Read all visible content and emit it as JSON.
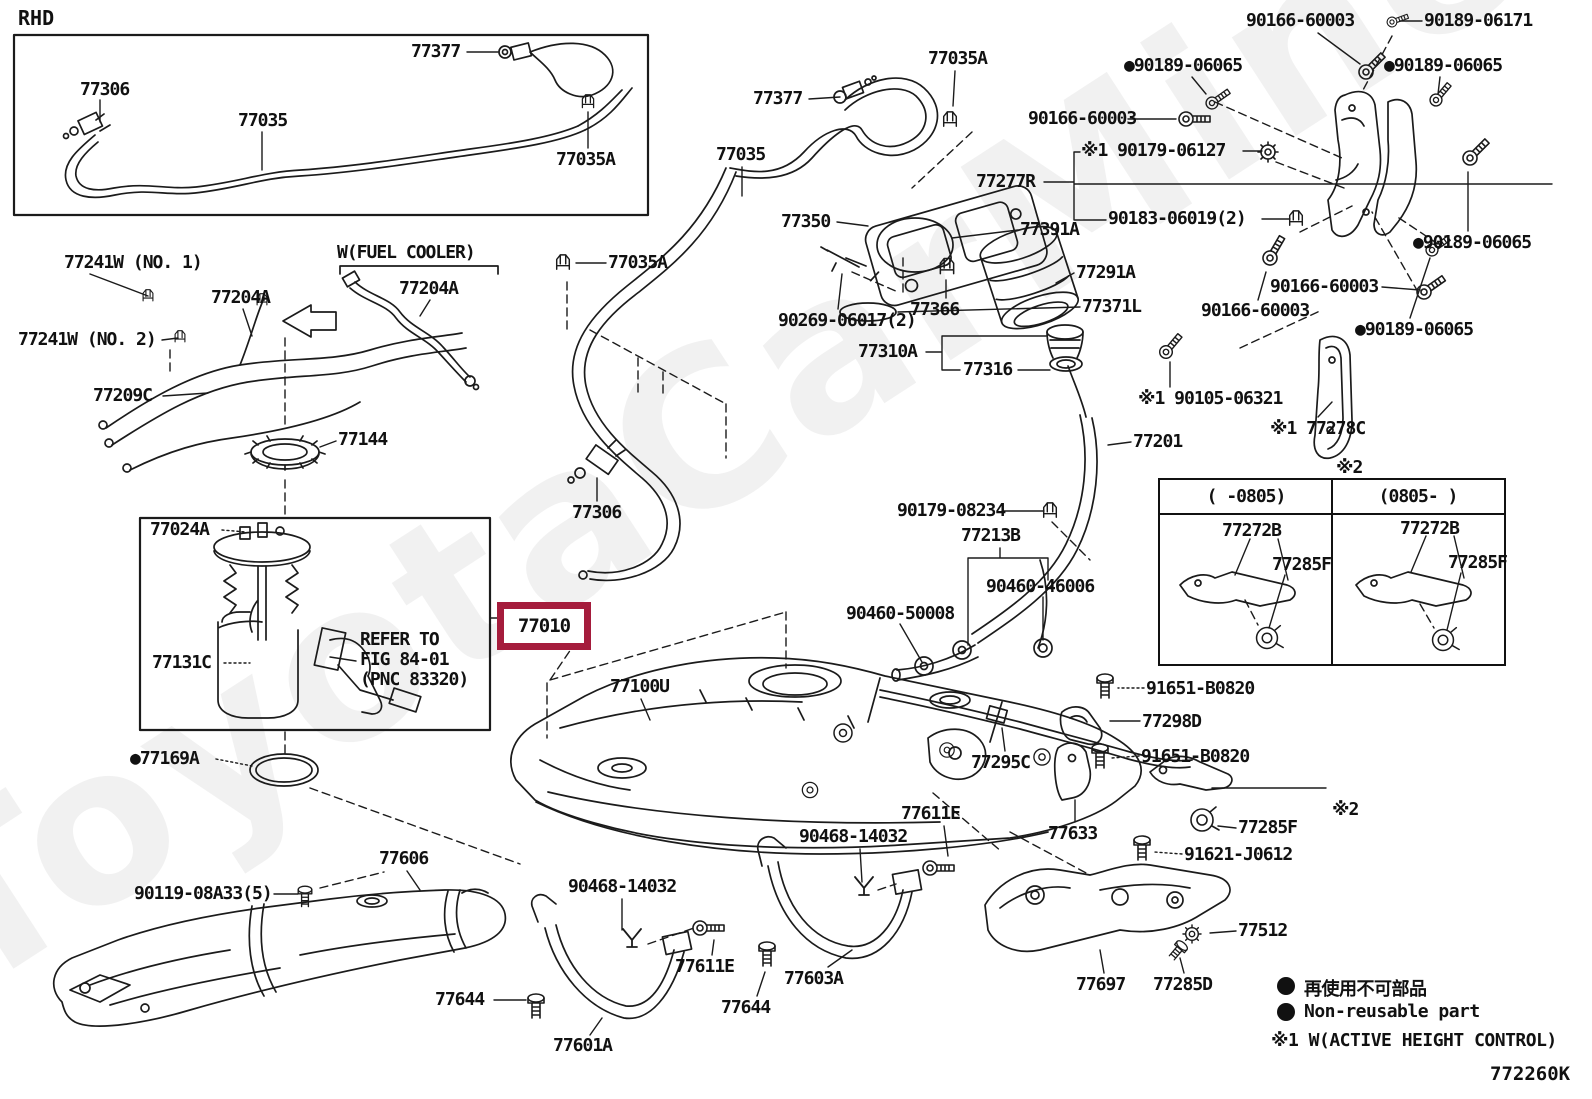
{
  "watermark": "ToyotaCarMine.ru",
  "diagram_code": "772260K",
  "inset_title": "RHD",
  "highlight": {
    "part_number": "77010",
    "box_color": "#A51C3C"
  },
  "legend": {
    "non_reusable_jp": "再使用不可部品",
    "non_reusable_en": "Non-reusable part",
    "active_height_note": "※1 W(ACTIVE HEIGHT CONTROL)"
  },
  "variant_table": {
    "note": "※2",
    "columns": [
      {
        "period": "(  -0805)",
        "bracket": "77272B",
        "clamp": "77285F"
      },
      {
        "period": "(0805-  )",
        "bracket": "77272B",
        "clamp": "77285F"
      }
    ]
  },
  "labels": [
    {
      "text": "77306",
      "x": 80,
      "y": 80
    },
    {
      "text": "77035",
      "x": 238,
      "y": 111
    },
    {
      "text": "77377",
      "x": 411,
      "y": 42
    },
    {
      "text": "77035A",
      "x": 556,
      "y": 150
    },
    {
      "text": "77241W (NO. 1)",
      "x": 64,
      "y": 253
    },
    {
      "text": "77241W (NO. 2)",
      "x": 18,
      "y": 330
    },
    {
      "text": "77204A",
      "x": 211,
      "y": 288
    },
    {
      "text": "W(FUEL COOLER)",
      "x": 337,
      "y": 243
    },
    {
      "text": "77204A",
      "x": 399,
      "y": 279
    },
    {
      "text": "77209C",
      "x": 93,
      "y": 386
    },
    {
      "text": "77144",
      "x": 338,
      "y": 430
    },
    {
      "text": "77024A",
      "x": 150,
      "y": 520
    },
    {
      "text": "77131C",
      "x": 152,
      "y": 653
    },
    {
      "text": "REFER TO\nFIG 84-01\n(PNC 83320)",
      "x": 360,
      "y": 630
    },
    {
      "text": "●77169A",
      "x": 130,
      "y": 749
    },
    {
      "text": "77100U",
      "x": 610,
      "y": 677
    },
    {
      "text": "77035A",
      "x": 608,
      "y": 253
    },
    {
      "text": "77306",
      "x": 572,
      "y": 503
    },
    {
      "text": "77035",
      "x": 716,
      "y": 145
    },
    {
      "text": "77377",
      "x": 753,
      "y": 89
    },
    {
      "text": "77035A",
      "x": 928,
      "y": 49
    },
    {
      "text": "77350",
      "x": 781,
      "y": 212
    },
    {
      "text": "90269-06017(2)",
      "x": 778,
      "y": 311
    },
    {
      "text": "77366",
      "x": 910,
      "y": 300
    },
    {
      "text": "77391A",
      "x": 1020,
      "y": 220
    },
    {
      "text": "77291A",
      "x": 1076,
      "y": 263
    },
    {
      "text": "77371L",
      "x": 1082,
      "y": 297
    },
    {
      "text": "77310A",
      "x": 858,
      "y": 342
    },
    {
      "text": "77316",
      "x": 963,
      "y": 360
    },
    {
      "text": "77277R",
      "x": 976,
      "y": 172
    },
    {
      "text": "90166-60003",
      "x": 1028,
      "y": 109
    },
    {
      "text": "※1 90179-06127",
      "x": 1081,
      "y": 141
    },
    {
      "text": "90183-06019(2)",
      "x": 1108,
      "y": 209
    },
    {
      "text": "90166-60003",
      "x": 1246,
      "y": 11
    },
    {
      "text": "90189-06171",
      "x": 1424,
      "y": 11
    },
    {
      "text": "●90189-06065",
      "x": 1124,
      "y": 56
    },
    {
      "text": "●90189-06065",
      "x": 1384,
      "y": 56
    },
    {
      "text": "●90189-06065",
      "x": 1413,
      "y": 233
    },
    {
      "text": "90166-60003",
      "x": 1270,
      "y": 277
    },
    {
      "text": "90166-60003",
      "x": 1201,
      "y": 301
    },
    {
      "text": "●90189-06065",
      "x": 1355,
      "y": 320
    },
    {
      "text": "※1 90105-06321",
      "x": 1138,
      "y": 389
    },
    {
      "text": "※1 77278C",
      "x": 1270,
      "y": 419
    },
    {
      "text": "77201",
      "x": 1133,
      "y": 432
    },
    {
      "text": "90179-08234",
      "x": 897,
      "y": 501
    },
    {
      "text": "77213B",
      "x": 961,
      "y": 526
    },
    {
      "text": "90460-46006",
      "x": 986,
      "y": 577
    },
    {
      "text": "90460-50008",
      "x": 846,
      "y": 604
    },
    {
      "text": "91651-B0820",
      "x": 1146,
      "y": 679
    },
    {
      "text": "77298D",
      "x": 1142,
      "y": 712
    },
    {
      "text": "91651-B0820",
      "x": 1141,
      "y": 747
    },
    {
      "text": "77295C",
      "x": 971,
      "y": 753
    },
    {
      "text": "77633",
      "x": 1048,
      "y": 824
    },
    {
      "text": "77285F",
      "x": 1238,
      "y": 818
    },
    {
      "text": "※2",
      "x": 1332,
      "y": 800
    },
    {
      "text": "91621-J0612",
      "x": 1184,
      "y": 845
    },
    {
      "text": "77606",
      "x": 379,
      "y": 849
    },
    {
      "text": "90119-08A33(5)",
      "x": 134,
      "y": 884
    },
    {
      "text": "77644",
      "x": 435,
      "y": 990
    },
    {
      "text": "77601A",
      "x": 553,
      "y": 1036
    },
    {
      "text": "90468-14032",
      "x": 568,
      "y": 877
    },
    {
      "text": "77611E",
      "x": 675,
      "y": 957
    },
    {
      "text": "77644",
      "x": 721,
      "y": 998
    },
    {
      "text": "77603A",
      "x": 784,
      "y": 969
    },
    {
      "text": "90468-14032",
      "x": 799,
      "y": 827
    },
    {
      "text": "77611E",
      "x": 901,
      "y": 804
    },
    {
      "text": "77697",
      "x": 1076,
      "y": 975
    },
    {
      "text": "77285D",
      "x": 1153,
      "y": 975
    },
    {
      "text": "77512",
      "x": 1238,
      "y": 921
    },
    {
      "text": "※2",
      "x": 1336,
      "y": 458
    }
  ]
}
